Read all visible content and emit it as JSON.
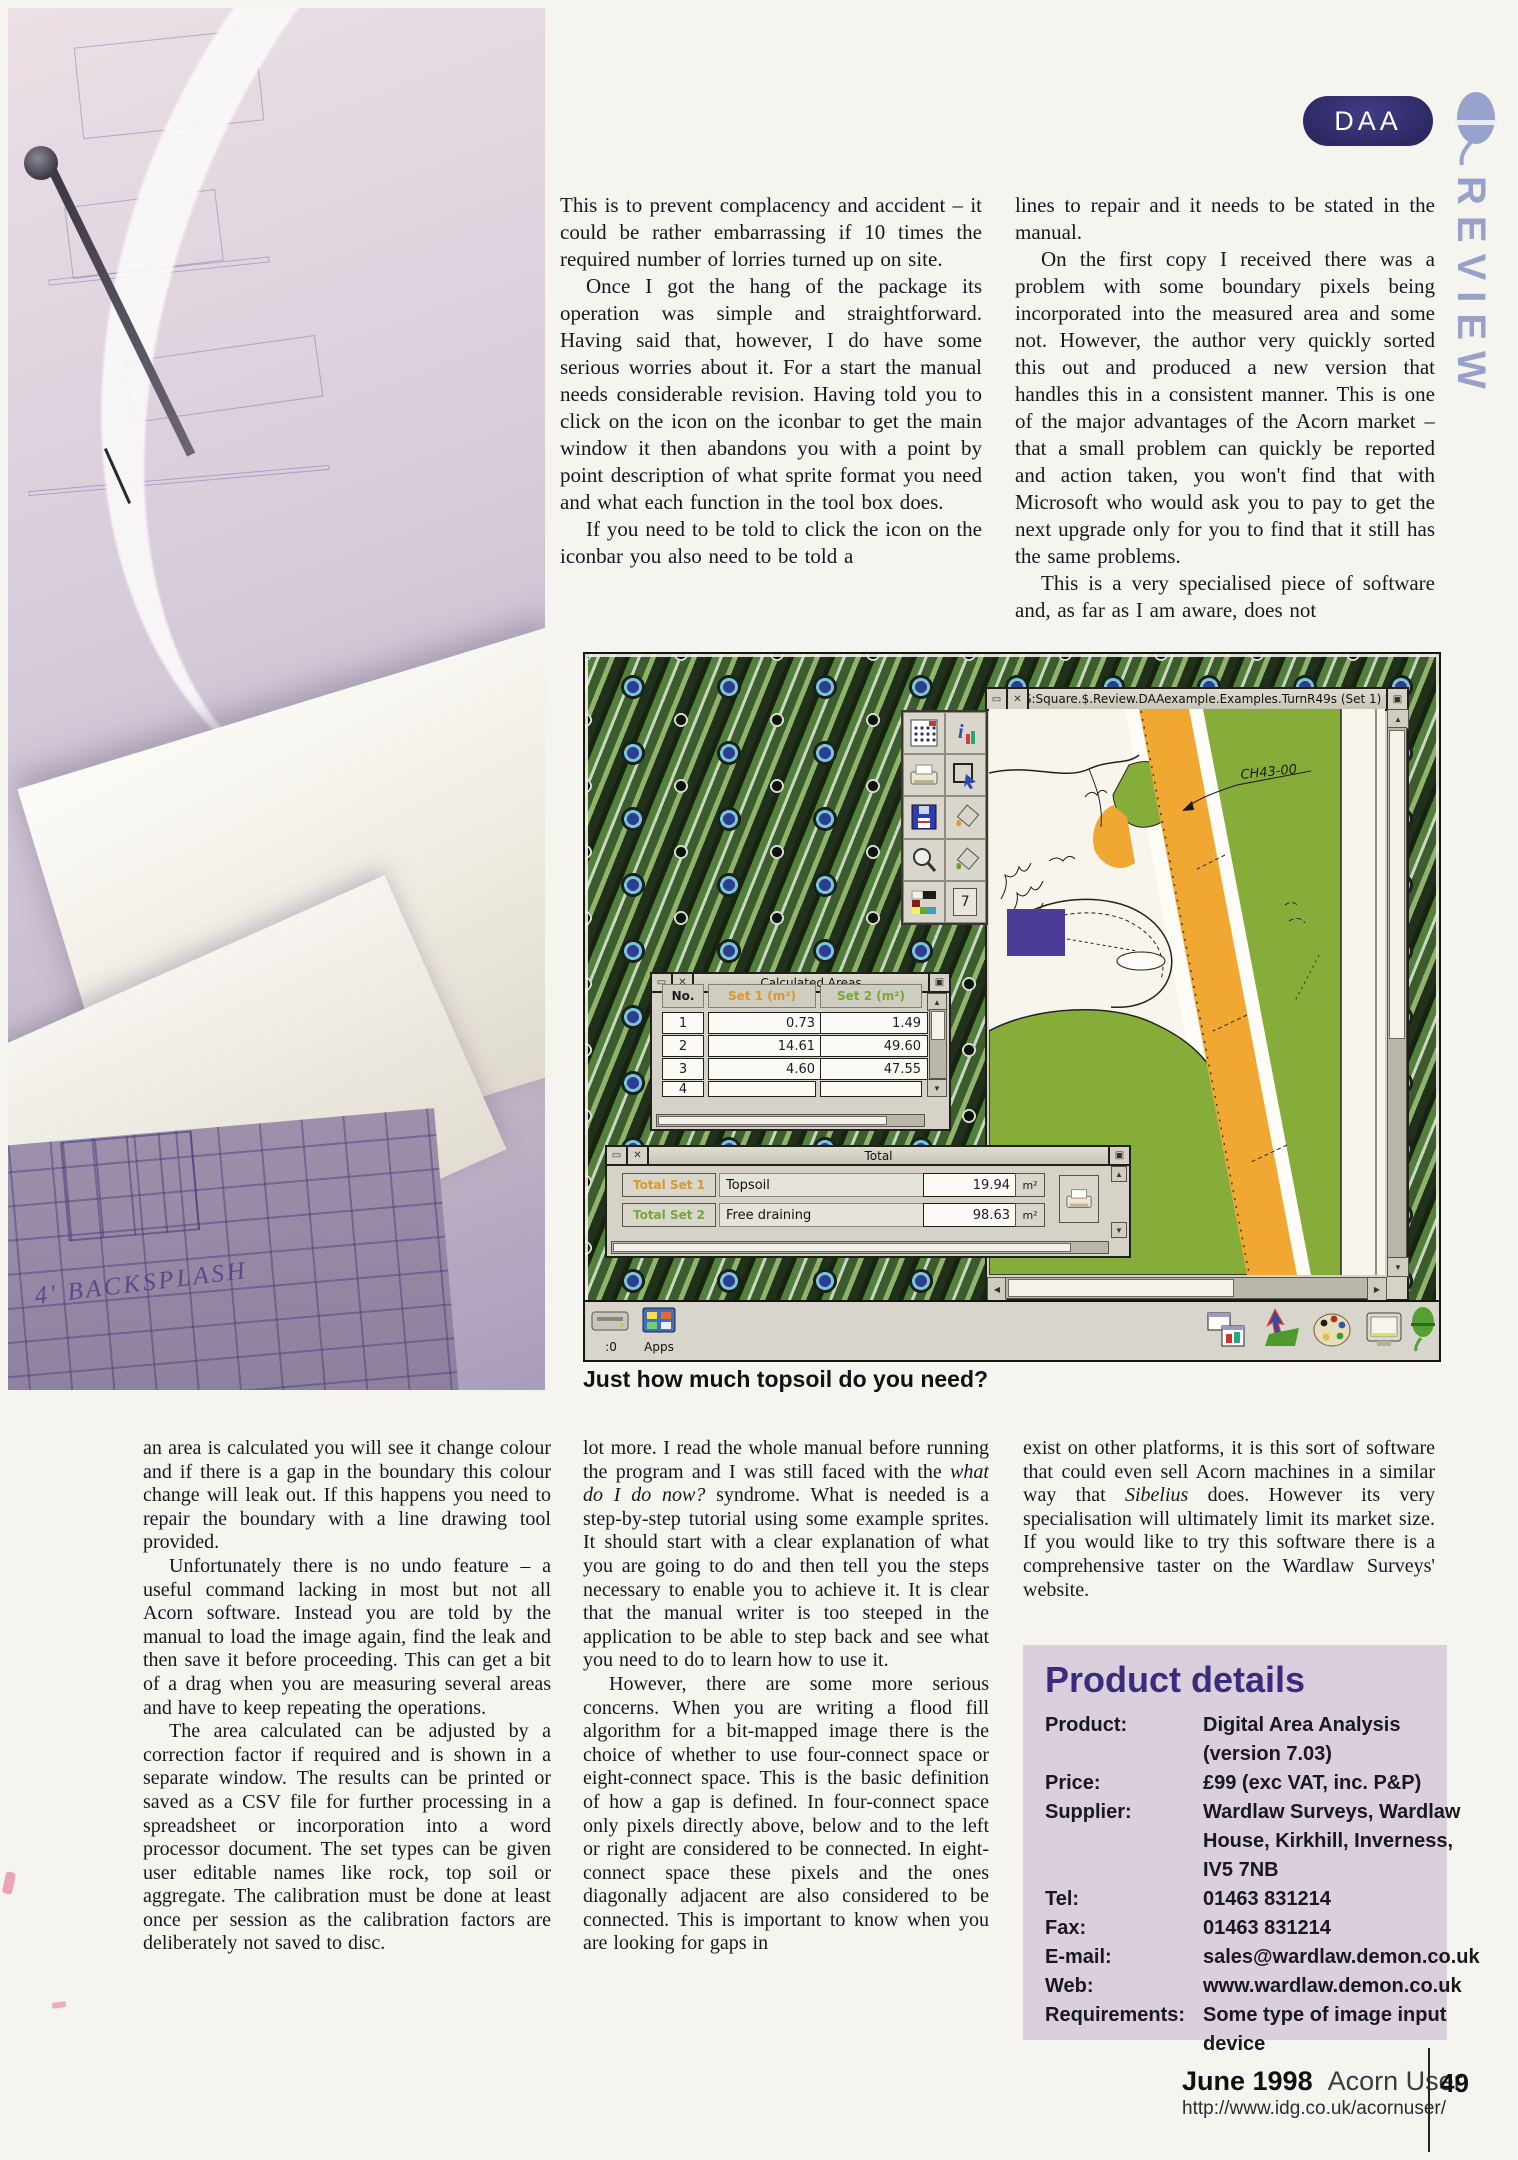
{
  "page": {
    "badge": "DAA",
    "section_vertical": "REVIEW",
    "caption": "Just how much topsoil do you need?",
    "photo_annotation": "4' BACKSPLASH",
    "footer": {
      "issue": "June 1998",
      "magazine": "Acorn User",
      "page_number": "49",
      "url": "http://www.idg.co.uk/acornuser/"
    },
    "colors": {
      "badge_navy": "#2c2963",
      "review_periwinkle": "#96a2ca",
      "product_box_bg": "#dbcedd",
      "product_title_purple": "#3a2c7c",
      "set1_orange": "#d6982f",
      "set2_green": "#76a73c",
      "map_green": "#86ad3a",
      "map_orange": "#f0a832",
      "map_purple_square": "#4b3c98"
    }
  },
  "article": {
    "top_col1": [
      "This is to prevent complacency and accident – it could be rather embarrassing if 10 times the required number of lorries turned up on site.",
      "Once I got the hang of the package its operation was simple and straightforward. Having said that, however, I do have some serious worries about it. For a start the manual needs considerable revision. Having told you to click on the icon on the iconbar to get the main window it then abandons you with a point by point description of what sprite format you need and what each function in the tool box does.",
      "If you need to be told to click the icon on the iconbar you also need to be told a"
    ],
    "top_col2": [
      "lines to repair and it needs to be stated in the manual.",
      "On the first copy I received there was a problem with some boundary pixels being incorporated into the measured area and some not. However, the author very quickly sorted this out and produced a new version that handles this in a consistent manner. This is one of the major advantages of the Acorn market – that a small problem can quickly be reported and action taken, you won't find that with Microsoft who would ask you to pay to get the next upgrade only for you to find that it still has the same problems.",
      "This is a very specialised piece of software and, as far as I am aware, does not"
    ],
    "bottom_col1": [
      "an area is calculated you will see it change colour and if there is a gap in the boundary this colour change will leak out. If this happens you need to repair the boundary with a line drawing tool provided.",
      "Unfortunately there is no undo feature – a useful command lacking in most but not all Acorn software. Instead you are told by the manual to load the image again, find the leak and then save it before proceeding. This can get a bit of a drag when you are measuring several areas and have to keep repeating the operations.",
      "The area calculated can be adjusted by a correction factor if required and is shown in a separate window. The results can be printed or saved as a CSV file for further processing in a spreadsheet or incorporation into a word processor document. The set types can be given user editable names like rock, top soil or aggregate. The calibration must be done at least once per session as the calibration factors are deliberately not saved to disc."
    ],
    "bottom_col2": {
      "p1_pre": "lot more. I read the whole manual before running the program and I was still faced with the ",
      "p1_italic": "what do I do now?",
      "p1_post": " syndrome. What is needed is a step-by-step tutorial using some example sprites. It should start with a clear explanation of what you are going to do and then tell you the steps necessary to enable you to achieve it. It is clear that the manual writer is too steeped in the application to be able to step back and see what you need to do to learn how to use it.",
      "p2": "However, there are some more serious concerns. When you are writing a flood fill algorithm for a bit-mapped image there is the choice of whether to use four-connect space or eight-connect space. This is the basic definition of how a gap is defined. In four-connect space only pixels directly above, below and to the left or right are considered to be connected. In eight-connect space these pixels and the ones diagonally adjacent are also considered to be connected. This is important to know when you are looking for gaps in"
    },
    "bottom_col3": {
      "pre": "exist on other platforms, it is this sort of software that could even sell Acorn machines in a similar way that ",
      "italic": "Sibelius",
      "post": " does. However its very specialisation will ultimately limit its market size. If you would like to try this software there is a comprehensive taster on the Wardlaw Surveys' website."
    }
  },
  "screenshot": {
    "window_title": "S:Square.$.Review.DAAexample.Examples.TurnR49s (Set 1) *",
    "map_label": "CH43-00",
    "toolbox": {
      "tool7_label": "7",
      "icons": [
        "grid-calc-icon",
        "info-icon",
        "print-icon",
        "select-icon",
        "save-icon",
        "fill-set1-icon",
        "zoom-icon",
        "fill-set2-icon",
        "palette-icon",
        "tool-7-box"
      ]
    },
    "calc": {
      "title": "Calculated Areas",
      "headers": [
        "No.",
        "Set 1 (m²)",
        "Set 2 (m²)"
      ],
      "rows": [
        [
          "1",
          "0.73",
          "1.49"
        ],
        [
          "2",
          "14.61",
          "49.60"
        ],
        [
          "3",
          "4.60",
          "47.55"
        ],
        [
          "4",
          "",
          ""
        ]
      ]
    },
    "total": {
      "title": "Total",
      "rows": [
        {
          "label": "Total Set 1",
          "name": "Topsoil",
          "value": "19.94",
          "unit": "m²"
        },
        {
          "label": "Total Set 2",
          "name": "Free draining",
          "value": "98.63",
          "unit": "m²"
        }
      ]
    },
    "iconbar": {
      "drive_label": ":0",
      "apps_label": "Apps",
      "right_icons": [
        "daa-app-icon",
        "pointer-map-icon",
        "palette-app-icon",
        "display-icon",
        "acorn-green-icon"
      ]
    }
  },
  "product": {
    "title": "Product details",
    "rows": [
      {
        "label": "Product:",
        "value": "Digital Area Analysis (version 7.03)"
      },
      {
        "label": "Price:",
        "value": "£99 (exc VAT, inc. P&P)"
      },
      {
        "label": "Supplier:",
        "value": "Wardlaw Surveys, Wardlaw House, Kirkhill, Inverness, IV5 7NB"
      },
      {
        "label": "Tel:",
        "value": "01463 831214"
      },
      {
        "label": "Fax:",
        "value": "01463 831214"
      },
      {
        "label": "E-mail:",
        "value": "sales@wardlaw.demon.co.uk"
      },
      {
        "label": "Web:",
        "value": "www.wardlaw.demon.co.uk"
      },
      {
        "label": "Requirements:",
        "value": "Some type of image input device"
      }
    ]
  }
}
